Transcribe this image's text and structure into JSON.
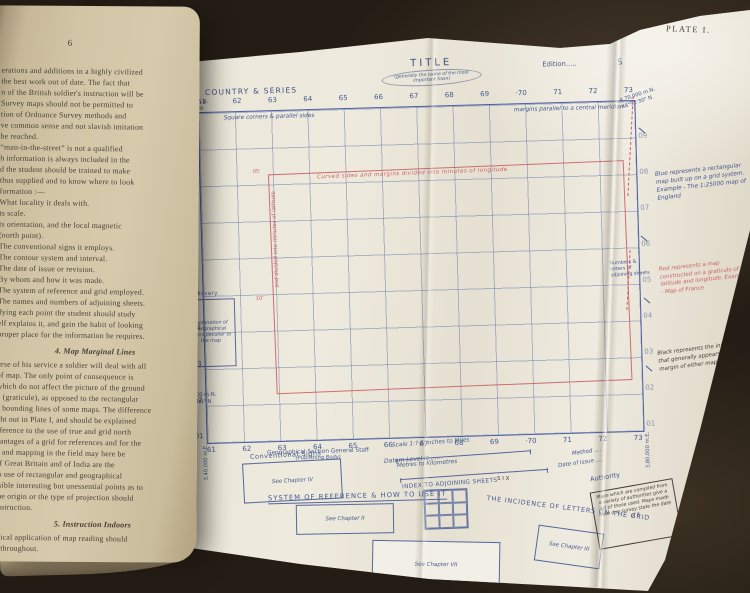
{
  "photo": {
    "background": "#241d15"
  },
  "book": {
    "page_number": "6",
    "lines_a": [
      "erations and additions in a highly civilized",
      "the best work out of date.  The fact that",
      "n of the British soldier's instruction will be",
      "Survey maps should not be permitted to",
      "tion of Ordnance Survey methods and",
      "ve common sense and not slavish imitation",
      "be reached.",
      "“man-in-the-street” is not a qualified",
      "h information is always included in the",
      "d the student should be trained to make",
      "thus supplied and to know where to look",
      "formation :—",
      "What locality it deals with.",
      "ts scale.",
      "ts orientation, and the local magnetic",
      "(north point).",
      "The conventional signs it employs.",
      "The contour system and interval.",
      "The date of issue or revision.",
      "By whom and how it was made.",
      "The system of reference and grid employed.",
      "The names and numbers of adjoining sheets.",
      "dying each point the student should study",
      "elf explains it, and gain the habit of looking",
      "proper place for the information he requires."
    ],
    "heading_4": "4.  Map Marginal Lines",
    "lines_b": [
      "urse of his service a soldier will deal with all",
      "of map.  The only point of consequence is",
      "which do not affect the picture of the ground",
      "d (graticule), as opposed to the rectangular",
      "e bounding lines of some maps.  The difference",
      "ght out in Plate I, and should be explained",
      "eference to the use of true and grid north",
      "vantages of a grid for references and for the",
      "g and mapping in the field may here be",
      "of Great Britain and of India are the",
      "to use of rectangular and geographical",
      "ssible interesting but unessential points as to",
      "the origin or the type of projection should",
      "instruction."
    ],
    "heading_5": "5.  Instruction Indoors",
    "lines_c": [
      "ctical application of map reading should",
      "d throughout."
    ]
  },
  "plate": {
    "label": "PLATE I.",
    "header": {
      "country_series": "COUNTRY & SERIES",
      "title": "TITLE",
      "title_note": "(generally the name of the most important town)",
      "edition": "Edition.....",
      "sheet_partial": "S"
    },
    "grid": {
      "top_numbers": [
        "61",
        "62",
        "63",
        "64",
        "65",
        "66",
        "67",
        "68",
        "69",
        "·70",
        "71",
        "72",
        "73"
      ],
      "bottom_numbers": [
        "61",
        "62",
        "63",
        "64",
        "65",
        "66",
        "67",
        "68",
        "69",
        "·70",
        "71",
        "72",
        "73"
      ],
      "left_numbers": [
        "09",
        "08",
        "07",
        "06",
        "05",
        "04",
        "03",
        "02",
        "01"
      ],
      "right_numbers": [
        "09",
        "08",
        "07",
        "06",
        "05",
        "04",
        "03",
        "02",
        "01"
      ],
      "inner_note_left": "Square corners & parallel sides",
      "inner_note_right": "margins parallel to a central meridian"
    },
    "coords": {
      "top_left_grid": "4,70,000 m.N.",
      "top_left_lat": "48°52'30\" N",
      "bottom_left_grid": "4,40,000 m.N.",
      "bottom_left_lat": "48°30'00\" N",
      "left_easting_top": "3,40,000 m.E.",
      "left_easting_bottom": "3,40,000 m.E.",
      "right_easting": "3,80,000 m.E.",
      "top_right_grid": "4,70,000 m.N.",
      "top_right_lat": "48°52'30\" N"
    },
    "red_map": {
      "top_note": "Curved sides and margins divided into minutes of longitude",
      "left_note": "and divided into minutes of latitude",
      "tick_top": "05'",
      "tick_left": "10'"
    },
    "glossary": {
      "title": "Glossary",
      "text": "Explanation of geographical terms peculiar to the map"
    },
    "footer": {
      "publisher": "Geographical Section General Staff",
      "publisher_note": "(Publishing Body)",
      "conventional_signs": "Conventional Signs",
      "conventional_box": "See Chapter IV",
      "datum": "Datum Level is .....",
      "scale_miles": "Scale 1:? & inches to Miles",
      "scale_km": "Metres to Kilometres",
      "index_adjoining": "INDEX TO ADJOINING SHEETS",
      "six": "S I X",
      "method": "Method ....",
      "date_of_issue": "Date of issue ....",
      "authority_title": "Authority",
      "authority_text": "Maps which are compiled from a variety of authorities give a list of those used. Maps made from one survey state the date of it.",
      "system_heading": "SYSTEM OF REFERENCE & HOW TO USE IT",
      "system_box": "See Chapter II",
      "center_box": "See Chapter VII",
      "incidence_heading": "THE INCIDENCE OF LETTERS ON THE GRID",
      "incidence_box": "See Chapter III"
    },
    "margin_key": {
      "blue": "Blue represents a rectangular map built up on a grid system. Example - The 1:25000 map of England",
      "adjoining_note": "Numbers & letters of adjoining sheets",
      "red": "Red represents a map constructed on a graticule of latitude and longitude. Example - Map of France",
      "black": "Black represents the information that generally appears on the margin of either map"
    },
    "colors": {
      "blue_ink": "#44598f",
      "red_ink": "#cc5f66",
      "plate_paper": "#eeeadd",
      "book_paper": "#d2c5a6"
    }
  }
}
